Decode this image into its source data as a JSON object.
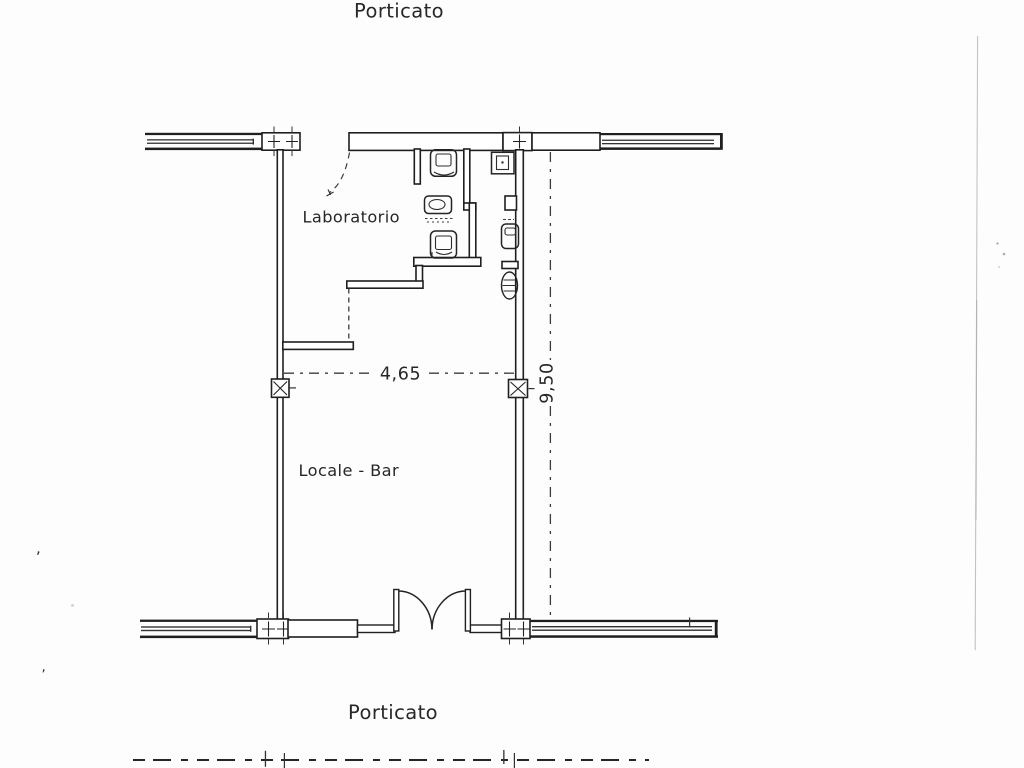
{
  "plan": {
    "area_top_label": "Porticato",
    "area_bottom_label": "Porticato",
    "rooms": [
      {
        "name": "laboratorio",
        "label": "Laboratorio"
      },
      {
        "name": "locale_bar",
        "label": "Locale - Bar"
      }
    ],
    "dimensions": {
      "width_label": "4,65",
      "height_label": "9,50"
    }
  },
  "artifacts": {
    "speck_comma_upper": ",",
    "speck_comma_lower": ","
  },
  "colors": {
    "paper": "#fdfdfd",
    "ink": "#1f1f1f",
    "scan_fold": "#b8b8b8"
  }
}
